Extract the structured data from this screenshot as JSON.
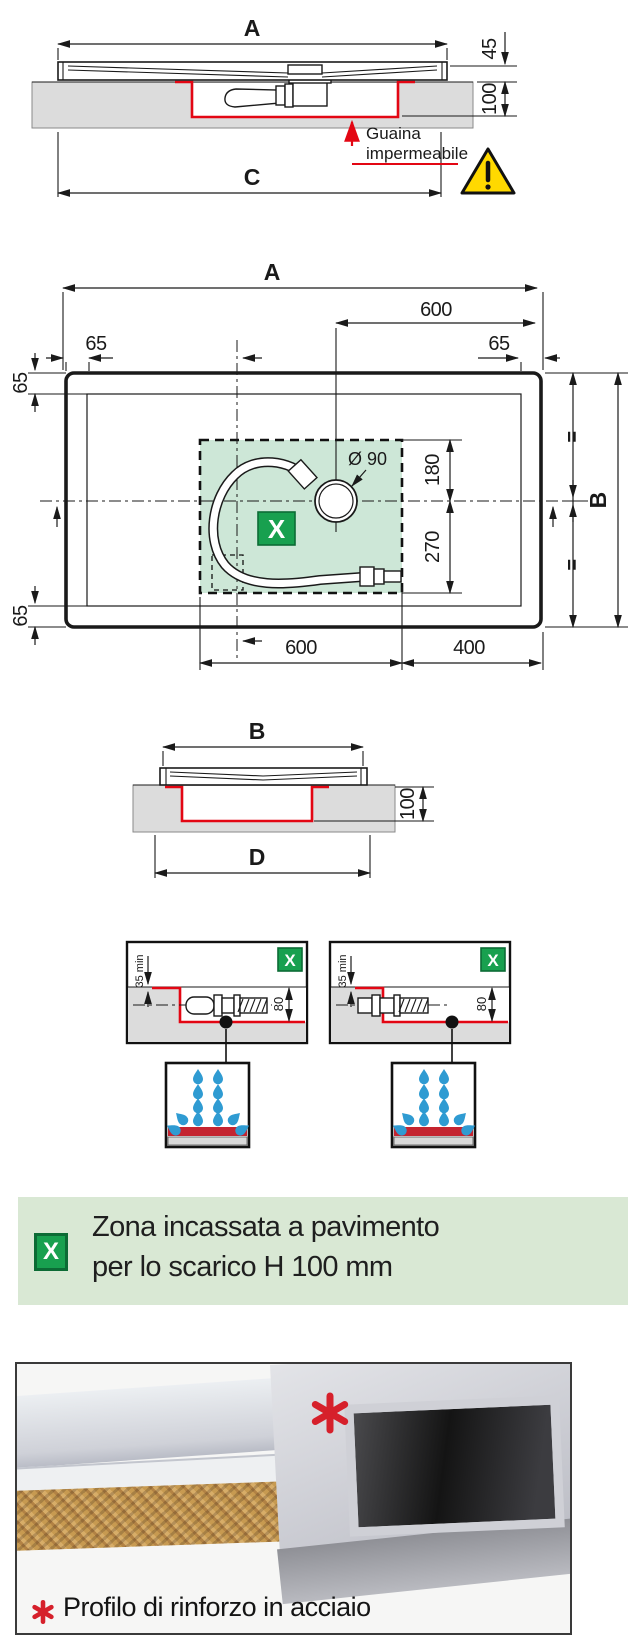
{
  "colors": {
    "red_line": "#e30613",
    "note_red": "#e14b57",
    "gray_fill": "#dcdcdc",
    "green_zone": "#cde7d7",
    "green_badge": "#18a04f",
    "banner_bg": "#d9e8d4",
    "drop_blue": "#2f9bd2",
    "warning_yellow": "#ffd900"
  },
  "section_top": {
    "dim_a": "A",
    "dim_45": "45",
    "dim_100": "100",
    "dim_c": "C",
    "note_line1": "Guaina",
    "note_line2": "impermeabile"
  },
  "plan": {
    "dim_a": "A",
    "dim_600_top": "600",
    "dim_65_top_left": "65",
    "dim_65_top_right": "65",
    "dim_65_left_top": "65",
    "dim_65_left_bottom": "65",
    "diameter": "Ø 90",
    "dim_180": "180",
    "dim_270": "270",
    "dim_600_bottom": "600",
    "dim_400": "400",
    "dim_b": "B",
    "equal_top": "=",
    "equal_bottom": "=",
    "zone_badge": "X"
  },
  "section_b": {
    "dim_b": "B",
    "dim_100": "100",
    "dim_d": "D"
  },
  "details": {
    "left": {
      "badge": "X",
      "dim_35": "35 min",
      "dim_80": "80"
    },
    "right": {
      "badge": "X",
      "dim_35": "35 min",
      "dim_80": "80"
    }
  },
  "banner": {
    "badge": "X",
    "line1": "Zona incassata a pavimento",
    "line2": "per lo scarico H 100 mm"
  },
  "photo": {
    "caption": "Profilo di rinforzo in acciaio"
  }
}
